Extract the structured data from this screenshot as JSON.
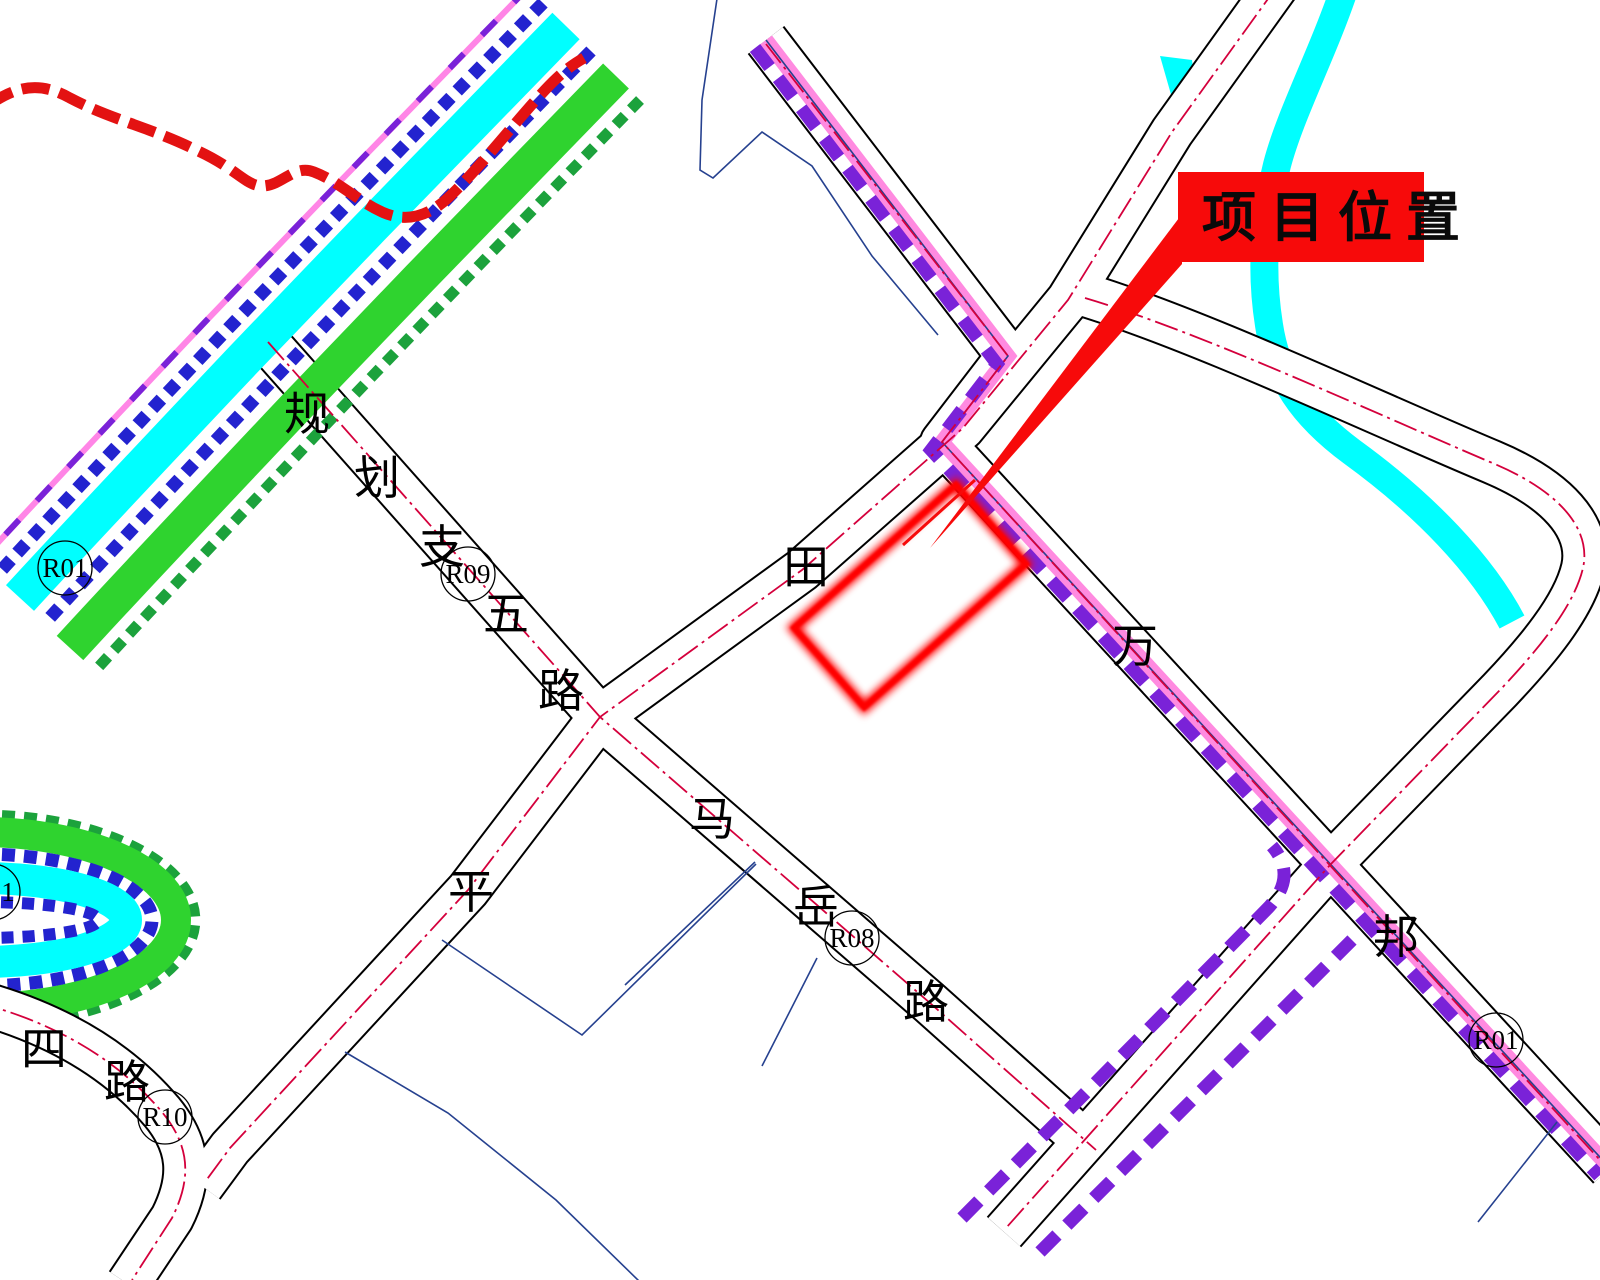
{
  "callout": {
    "label": "项目位置"
  },
  "roads": {
    "guihua": {
      "name": "规划支五路",
      "chars": [
        "规",
        "划",
        "支",
        "五",
        "路"
      ],
      "code": "R09"
    },
    "tianping": {
      "chars": [
        "田",
        "平"
      ]
    },
    "mayue": {
      "chars": [
        "马",
        "岳",
        "路"
      ],
      "code": "R08"
    },
    "wanbang": {
      "chars": [
        "万",
        "邦"
      ],
      "code": "R01"
    },
    "silu": {
      "chars": [
        "四",
        "路"
      ],
      "code": "R10"
    },
    "west": {
      "code": "R01"
    },
    "partial": {
      "code": "1"
    }
  },
  "colors": {
    "site_red": "#ff0000",
    "callout_bg": "#f70a0a",
    "callout_text": "#0a0a0a",
    "river_cyan": "#00ffff",
    "greenbelt_green": "#2fd32f",
    "greenbelt_cyan": "#00ffff",
    "dot_blue": "#2323cf",
    "edge_darkgreen": "#1ca23c",
    "edge_pink": "#ff85e6",
    "planned_purple": "#7a22d8",
    "centerline_red": "#d4003c",
    "boundary_red": "#e31212",
    "parcel_navy": "#26418f",
    "road_black": "#000000"
  }
}
